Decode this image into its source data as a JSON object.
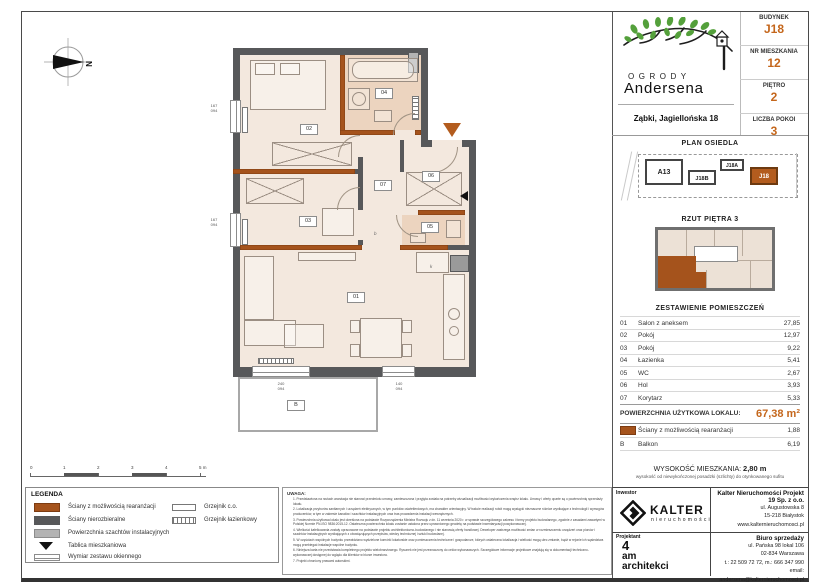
{
  "colors": {
    "accent": "#c4661b",
    "wall_dark": "#57585a",
    "wall_orange": "#a5531c",
    "floor": "#f3e8de",
    "wet": "#ecd4bf"
  },
  "header": {
    "logo_line1": "OGRODY",
    "logo_line2": "Andersena",
    "address": "Ząbki, Jagiellońska 18",
    "info": [
      {
        "label": "BUDYNEK",
        "value": "J18"
      },
      {
        "label": "NR MIESZKANIA",
        "value": "12"
      },
      {
        "label": "PIĘTRO",
        "value": "2"
      },
      {
        "label": "LICZBA POKOI",
        "value": "3"
      }
    ]
  },
  "site_plan": {
    "title": "PLAN OSIEDLA",
    "buildings": [
      "A13",
      "J18B",
      "J18A",
      "J18"
    ],
    "highlighted": "J18"
  },
  "floor_overview": {
    "title": "RZUT PIĘTRA 3"
  },
  "rooms_table": {
    "title": "ZESTAWIENIE POMIESZCZEŃ",
    "rows": [
      {
        "no": "01",
        "name": "Salon z aneksem",
        "area": "27,85"
      },
      {
        "no": "02",
        "name": "Pokój",
        "area": "12,97"
      },
      {
        "no": "03",
        "name": "Pokój",
        "area": "9,22"
      },
      {
        "no": "04",
        "name": "Łazienka",
        "area": "5,41"
      },
      {
        "no": "05",
        "name": "WC",
        "area": "2,67"
      },
      {
        "no": "06",
        "name": "Hol",
        "area": "3,93"
      },
      {
        "no": "07",
        "name": "Korytarz",
        "area": "5,33"
      }
    ],
    "total_label": "POWIERZCHNIA UŻYTKOWA LOKALU:",
    "total_value": "67,38 m²",
    "walls_row": {
      "name": "Ściany z możliwością rearanżacji",
      "area": "1,88"
    },
    "balcony_row": {
      "no": "B",
      "name": "Balkon",
      "area": "6,19"
    }
  },
  "height_note": {
    "label": "WYSOKOŚĆ MIESZKANIA:",
    "value": "2,80 m",
    "sub": "wysokość od niewykończonej posadzki (szlichty) do otynkowanego sufitu"
  },
  "plan": {
    "compass": "N",
    "labels": {
      "r01": "01",
      "r02": "02",
      "r03": "03",
      "r04": "04",
      "r05": "05",
      "r06": "06",
      "r07": "07",
      "balcony": "B"
    },
    "marks": {
      "kitchen": "k",
      "corridor": "b"
    },
    "window_dims": [
      {
        "w": "167",
        "h": "094"
      },
      {
        "w": "167",
        "h": "094"
      },
      {
        "w": "240",
        "h": "094"
      },
      {
        "w": "140",
        "h": "094"
      }
    ]
  },
  "scale_bar": {
    "ticks": [
      "0",
      "1",
      "2",
      "3",
      "4",
      "5 m"
    ]
  },
  "legend": {
    "title": "LEGENDA",
    "items": [
      {
        "label": "Ściany z możliwością rearanżacji"
      },
      {
        "label": "Ściany nierozbieralne"
      },
      {
        "label": "Powierzchnia szachtów instalacyjnych"
      },
      {
        "label": "Tablica mieszkaniowa"
      },
      {
        "label": "Wymiar zestawu okiennego"
      }
    ],
    "items_right": [
      {
        "label": "Grzejnik c.o."
      },
      {
        "label": "Grzejnik łazienkowy"
      }
    ]
  },
  "notes": {
    "title": "UWAGA:",
    "items": [
      "1. Przedstawiona na rzutach aranżacja nie stanowi przedmiotu umowy, zamieszczona i przyjęta została na potrzeby wizualizacji możliwości wykończenia wnętrz lokalu. Umowy i oferty oparte są o powierzchnię sprzedaży lokalu.",
      "2. Lokalizacja przyborów sanitarnych i urządzeń elektrycznych, w tym punktów oświetleniowych, ma charakter orientacyjny. W trakcie realizacji robót mogą wystąpić nieznaczne różnice wynikające z technologii i wymogów producentów, w tym w zakresie kanałów i szachtów instalacyjnych oraz tras prowadzenia instalacji wewnętrznych.",
      "3. Powierzchnia użytkowa lokalu jest określona na podstawie Rozporządzenia Ministra Rozwoju z dn. 11 września 2020 r. w sprawie szczegółowego zakresu i formy projektu budowlanego, zgodnie z zasadami zawartymi w Polskiej Normie PN-ISO 9836:2015-12. Ostateczna powierzchnia lokalu zostanie ustalona przez uprawnionego geodetę na podstawie inwentaryzacji powykonawczej.",
      "4. Wielkości kafelkowania zostały opracowane na podstawie projektu architektoniczno-budowlanego i nie stanowią oferty handlowej. Deweloper zastrzega możliwość zmian w rozmieszczeniu urządzeń oraz pionów i szachtów instalacyjnych wynikających z obowiązujących przepisów, wiedzy technicznej i sztuki budowlanej.",
      "5. W częściach wspólnych budynku przewidziano wydzielone komórki lokatorskie oraz pomieszczenia techniczne i gospodarcze, których ostateczna lokalizacja i wielkość mogą ulec zmianie, bądź w rejonie ich sąsiedztwa mogą przebiegać instalacje wspólne budynku.",
      "6. Niniejsza karta nie przedstawia kompletnego projektu wielobranżowego. Rysunek nie jest przeznaczony do celów wykonawczych. Szczegółowe informacje projektowe znajdują się w dokumentacji techniczno-wykonawczej dostępnej do wglądu dla klientów w biurze inwestora.",
      "7. Projekt chroniony prawami autorskimi."
    ]
  },
  "footer": {
    "investor_label": "Inwestor",
    "investor_name": "KALTER",
    "investor_sub": "nieruchomości",
    "company_name": "Kalter Nieruchomości Projekt 19 Sp. z o.o.",
    "company_lines": [
      "ul. Augustowska 8",
      "15-218 Białystok",
      "www.kalternieruchomosci.pl"
    ],
    "designer_label": "Projektant",
    "designer_name": {
      "l1": "4",
      "l2": "am",
      "l3": "architekci"
    },
    "office_label": "Biuro sprzedaży",
    "office_lines": [
      "ul. Pańska 98 lokal 106",
      "02-834 Warszawa",
      "t.: 22 509 72 72, m.: 666 347 990",
      "email: andersena@kalternieruchomosci.pl"
    ]
  }
}
